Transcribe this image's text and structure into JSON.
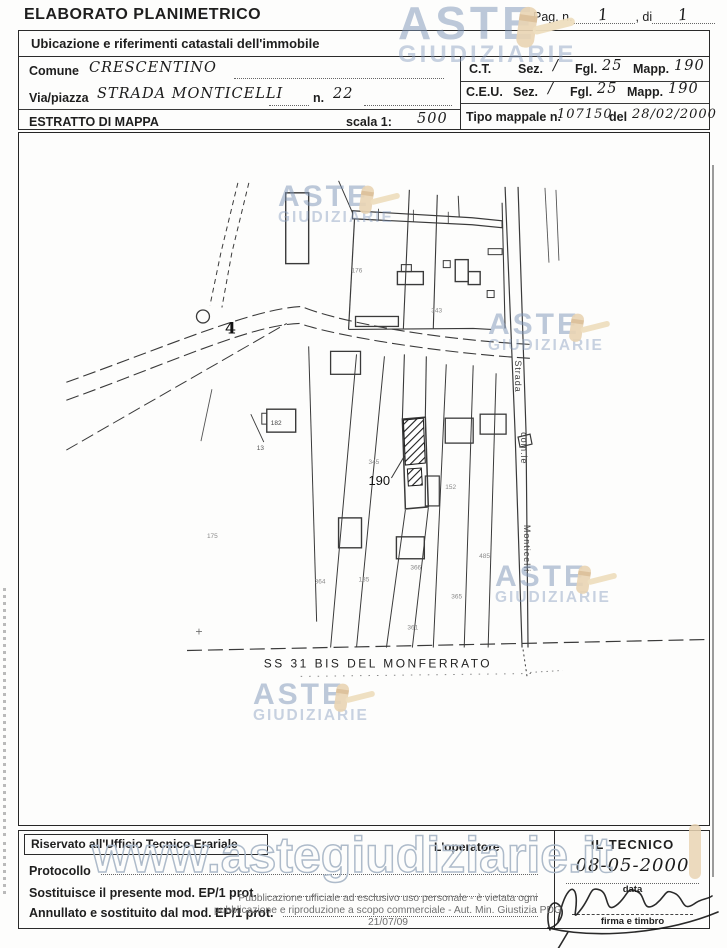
{
  "header": {
    "title": "ELABORATO PLANIMETRICO",
    "pag_label": "Pag. n.",
    "pag_value": "1",
    "di_label": ", di",
    "di_value": "1"
  },
  "location": {
    "heading": "Ubicazione e riferimenti catastali dell'immobile"
  },
  "form": {
    "comune_label": "Comune",
    "comune_value": "CRESCENTINO",
    "via_label": "Via/piazza",
    "via_value": "STRADA MONTICELLI",
    "n_label": "n.",
    "n_value": "22",
    "estratto_label": "ESTRATTO DI MAPPA",
    "scala_label": "scala 1:",
    "scala_value": "500",
    "ct_label": "C.T.",
    "ct_sez_label": "Sez.",
    "ct_sez_value": "/",
    "ct_fgl_label": "Fgl.",
    "ct_fgl_value": "25",
    "ct_mapp_label": "Mapp.",
    "ct_mapp_value": "190",
    "ceu_label": "C.E.U.",
    "ceu_sez_label": "Sez.",
    "ceu_sez_value": "/",
    "ceu_fgl_label": "Fgl.",
    "ceu_fgl_value": "25",
    "ceu_mapp_label": "Mapp.",
    "ceu_mapp_value": "190",
    "tipo_label": "Tipo mappale n.",
    "tipo_value": "107150",
    "tipo_del_label": "del",
    "tipo_del_value": "28/02/2000"
  },
  "map": {
    "junction_label": "4",
    "parcel_label": "190",
    "house_label": "182",
    "flag_label": "13",
    "road_right": {
      "l1": "Strada",
      "l2": "com.le",
      "l3": "Monticelli"
    },
    "road_bottom_label": "SS  31 BIS  DEL  MONFERRATO",
    "faint": [
      "176",
      "343",
      "345",
      "152",
      "175",
      "364",
      "185",
      "366",
      "365",
      "361",
      "485"
    ]
  },
  "footer": {
    "reserved_heading": "Riservato all'Ufficio Tecnico Erariale",
    "operator_label": "L'operatore",
    "protocollo_label": "Protocollo",
    "sostituisce_label": "Sostituisce il presente mod. EP/1 prot.",
    "annullato_label": "Annullato e sostituito dal mod. EP/1 prot.",
    "tecnico_heading": "IL TECNICO",
    "tecnico_date": "08-05-2000",
    "data_label": "data",
    "firma_label": "firma e timbro"
  },
  "watermark": {
    "line1": "ASTE",
    "line2": "GIUDIZIARIE",
    "url_text": "www.astegiudiziarie.it",
    "disclaimer1": "Pubblicazione ufficiale ad esclusivo uso personale - è vietata ogni",
    "disclaimer2": "pubblicazione e riproduzione a scopo commerciale - Aut. Min. Giustizia PDG 21/07/09",
    "accent_blue": "#7c94b6",
    "gavel_tan": "#e9d4b3"
  }
}
